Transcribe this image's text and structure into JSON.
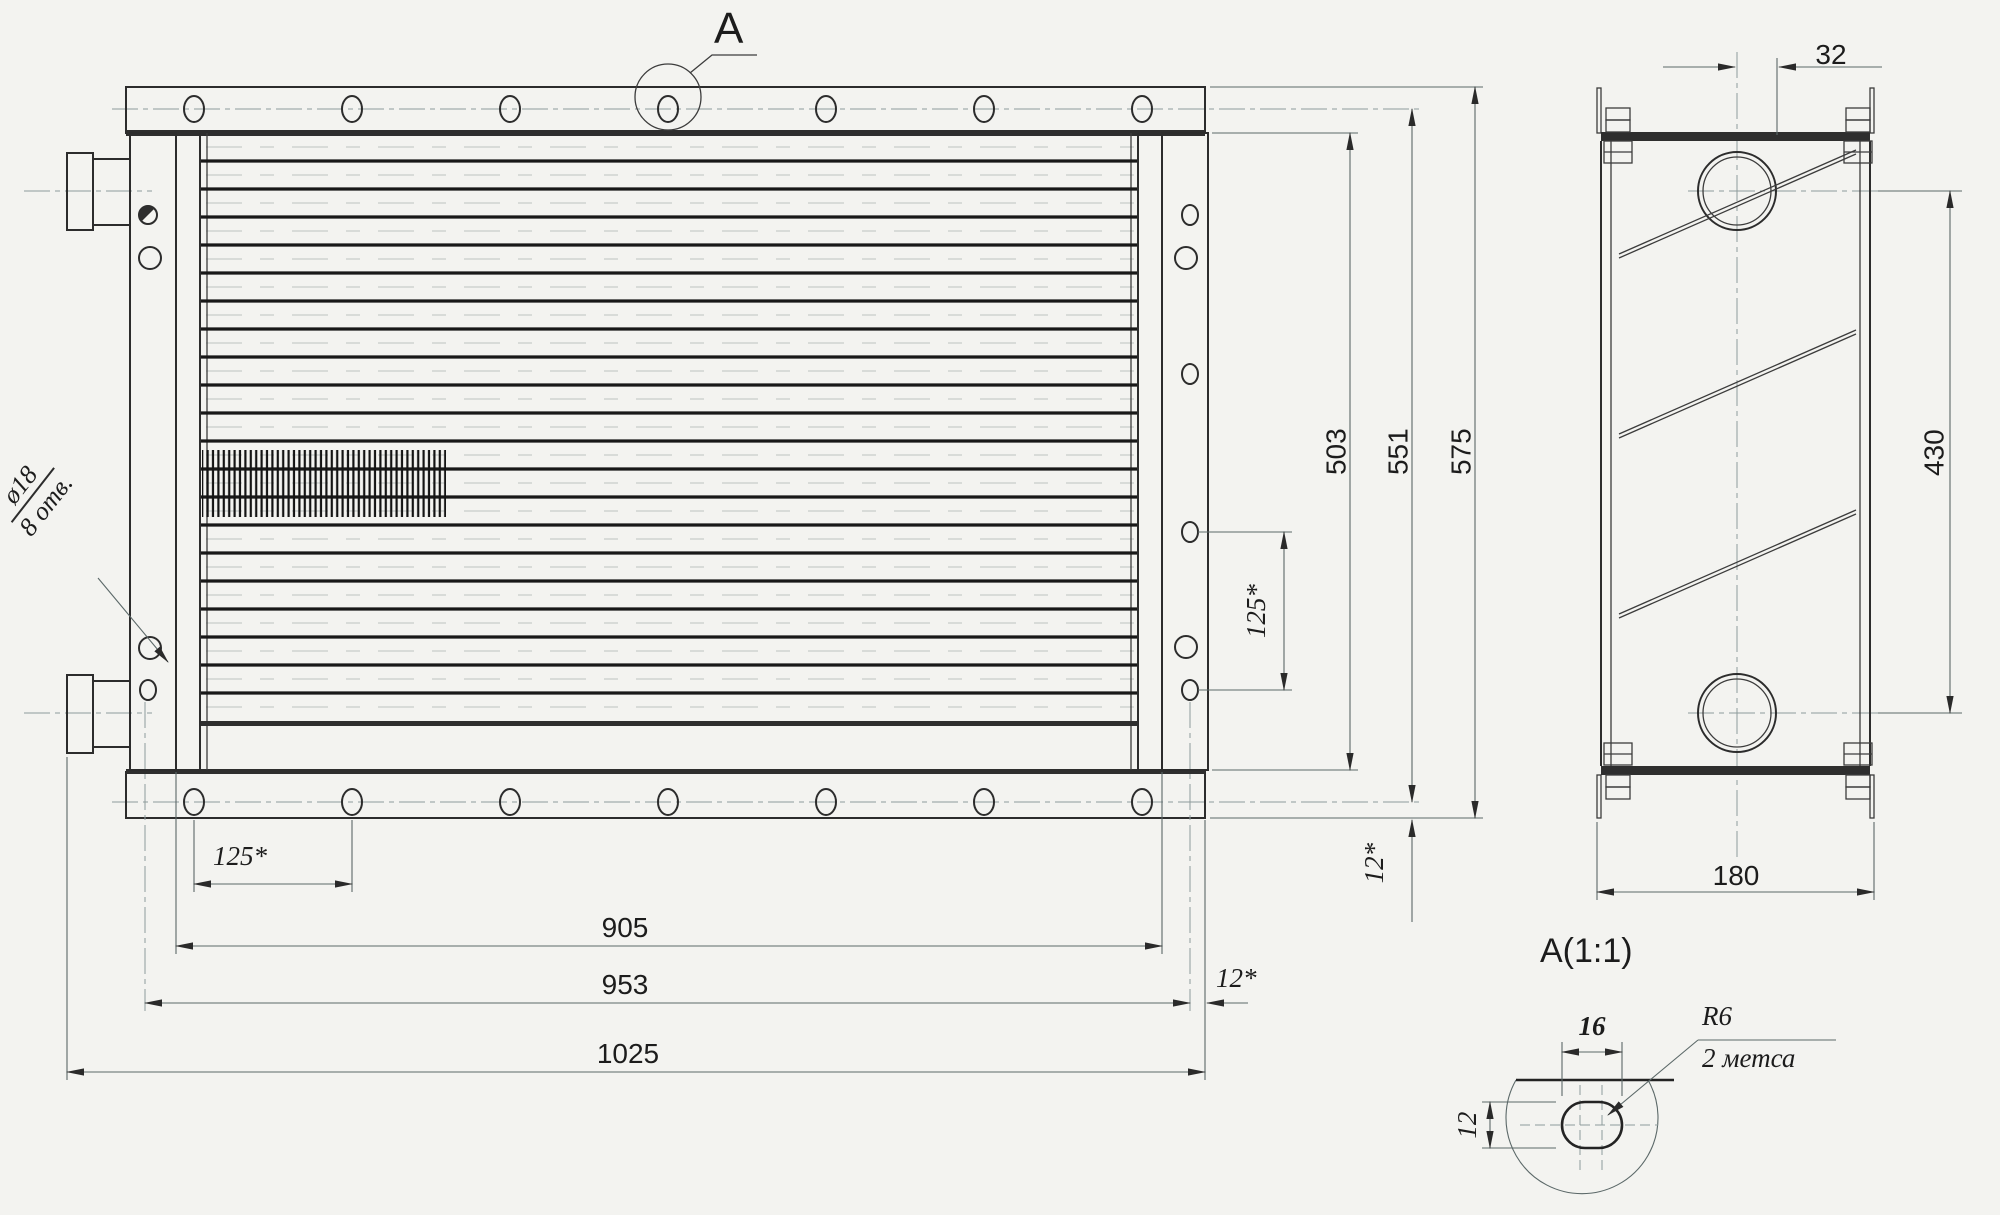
{
  "front_view": {
    "section_label": "A",
    "hole_callout": {
      "diameter": "ø18",
      "count": "8 отв."
    },
    "dimensions": {
      "hole_pitch_bottom": "125*",
      "core_width": "905",
      "mount_width": "953",
      "overall_width": "1025",
      "edge_offset_bottom": "12*",
      "hole_pitch_right": "125*",
      "core_height": "503",
      "mount_height": "551",
      "overall_height": "575",
      "edge_offset_right": "12*"
    }
  },
  "side_view": {
    "dimensions": {
      "pipe_offset": "32",
      "pipe_spacing": "430",
      "depth": "180"
    }
  },
  "detail_view": {
    "title": "A(1:1)",
    "dimensions": {
      "slot_width": "16",
      "slot_height": "12"
    },
    "radius_label": "R6",
    "places_note": "2 метса"
  }
}
